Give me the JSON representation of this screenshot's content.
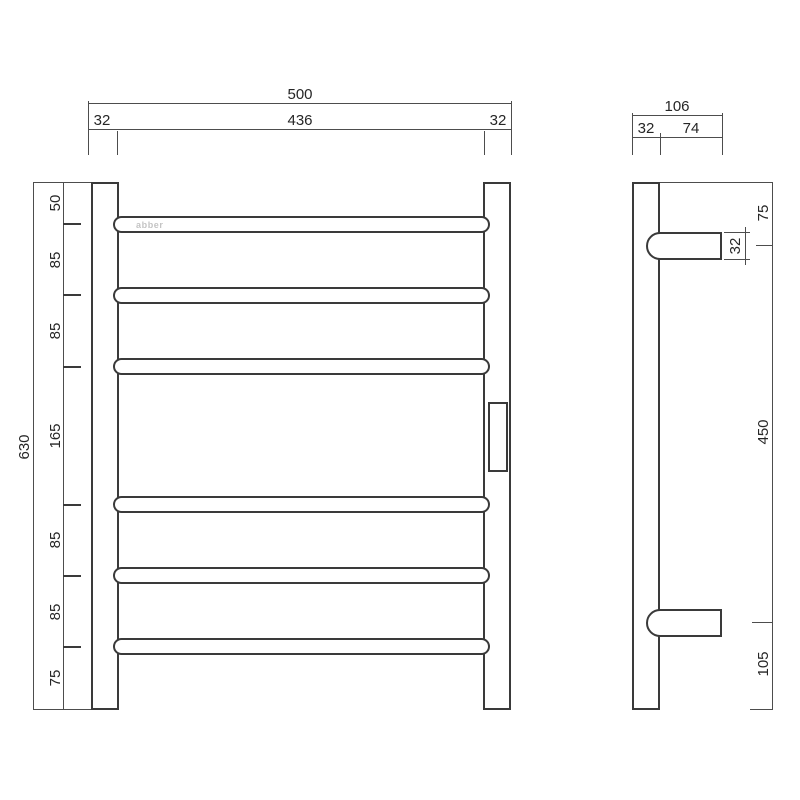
{
  "drawing": {
    "logo": "abber"
  },
  "front_view": {
    "top_dims": {
      "overall": "500",
      "left": "32",
      "middle": "436",
      "right": "32"
    },
    "left_dims": {
      "overall": "630",
      "segments": [
        "50",
        "85",
        "85",
        "165",
        "85",
        "85",
        "75"
      ]
    }
  },
  "side_view": {
    "top_dims": {
      "overall": "106",
      "left": "32",
      "right": "74"
    },
    "right_dims": {
      "segments": [
        "75",
        "450",
        "105"
      ],
      "bracket_depth": "32"
    }
  }
}
